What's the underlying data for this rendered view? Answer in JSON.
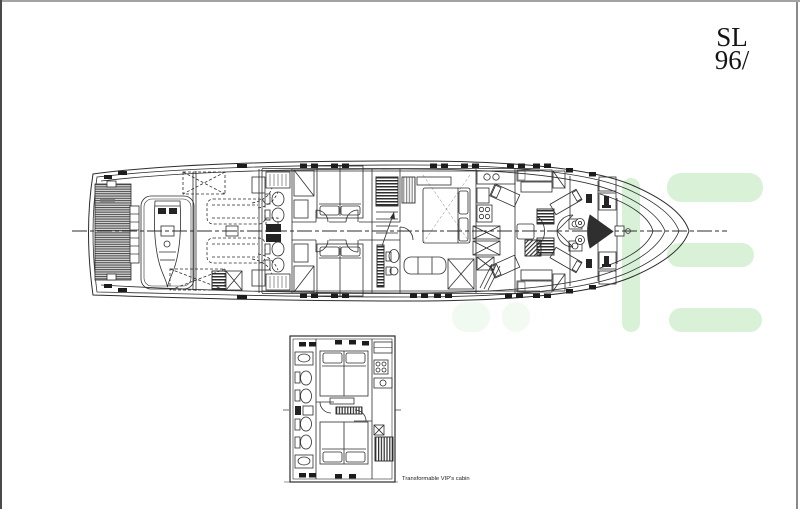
{
  "page": {
    "background": "#ffffff",
    "border_top_color": "#a3a3a3",
    "border_left_color": "#4a4a4a",
    "border_right_color": "#8a8a8a"
  },
  "brand": {
    "model_series": "SL",
    "model_number": "96/"
  },
  "inset": {
    "label": "Transformable VIP's cabin"
  },
  "drawing": {
    "ink_color": "#2d2d2d",
    "dark_fill_color": "#242424",
    "watermark_color": "#d9f1d7"
  }
}
